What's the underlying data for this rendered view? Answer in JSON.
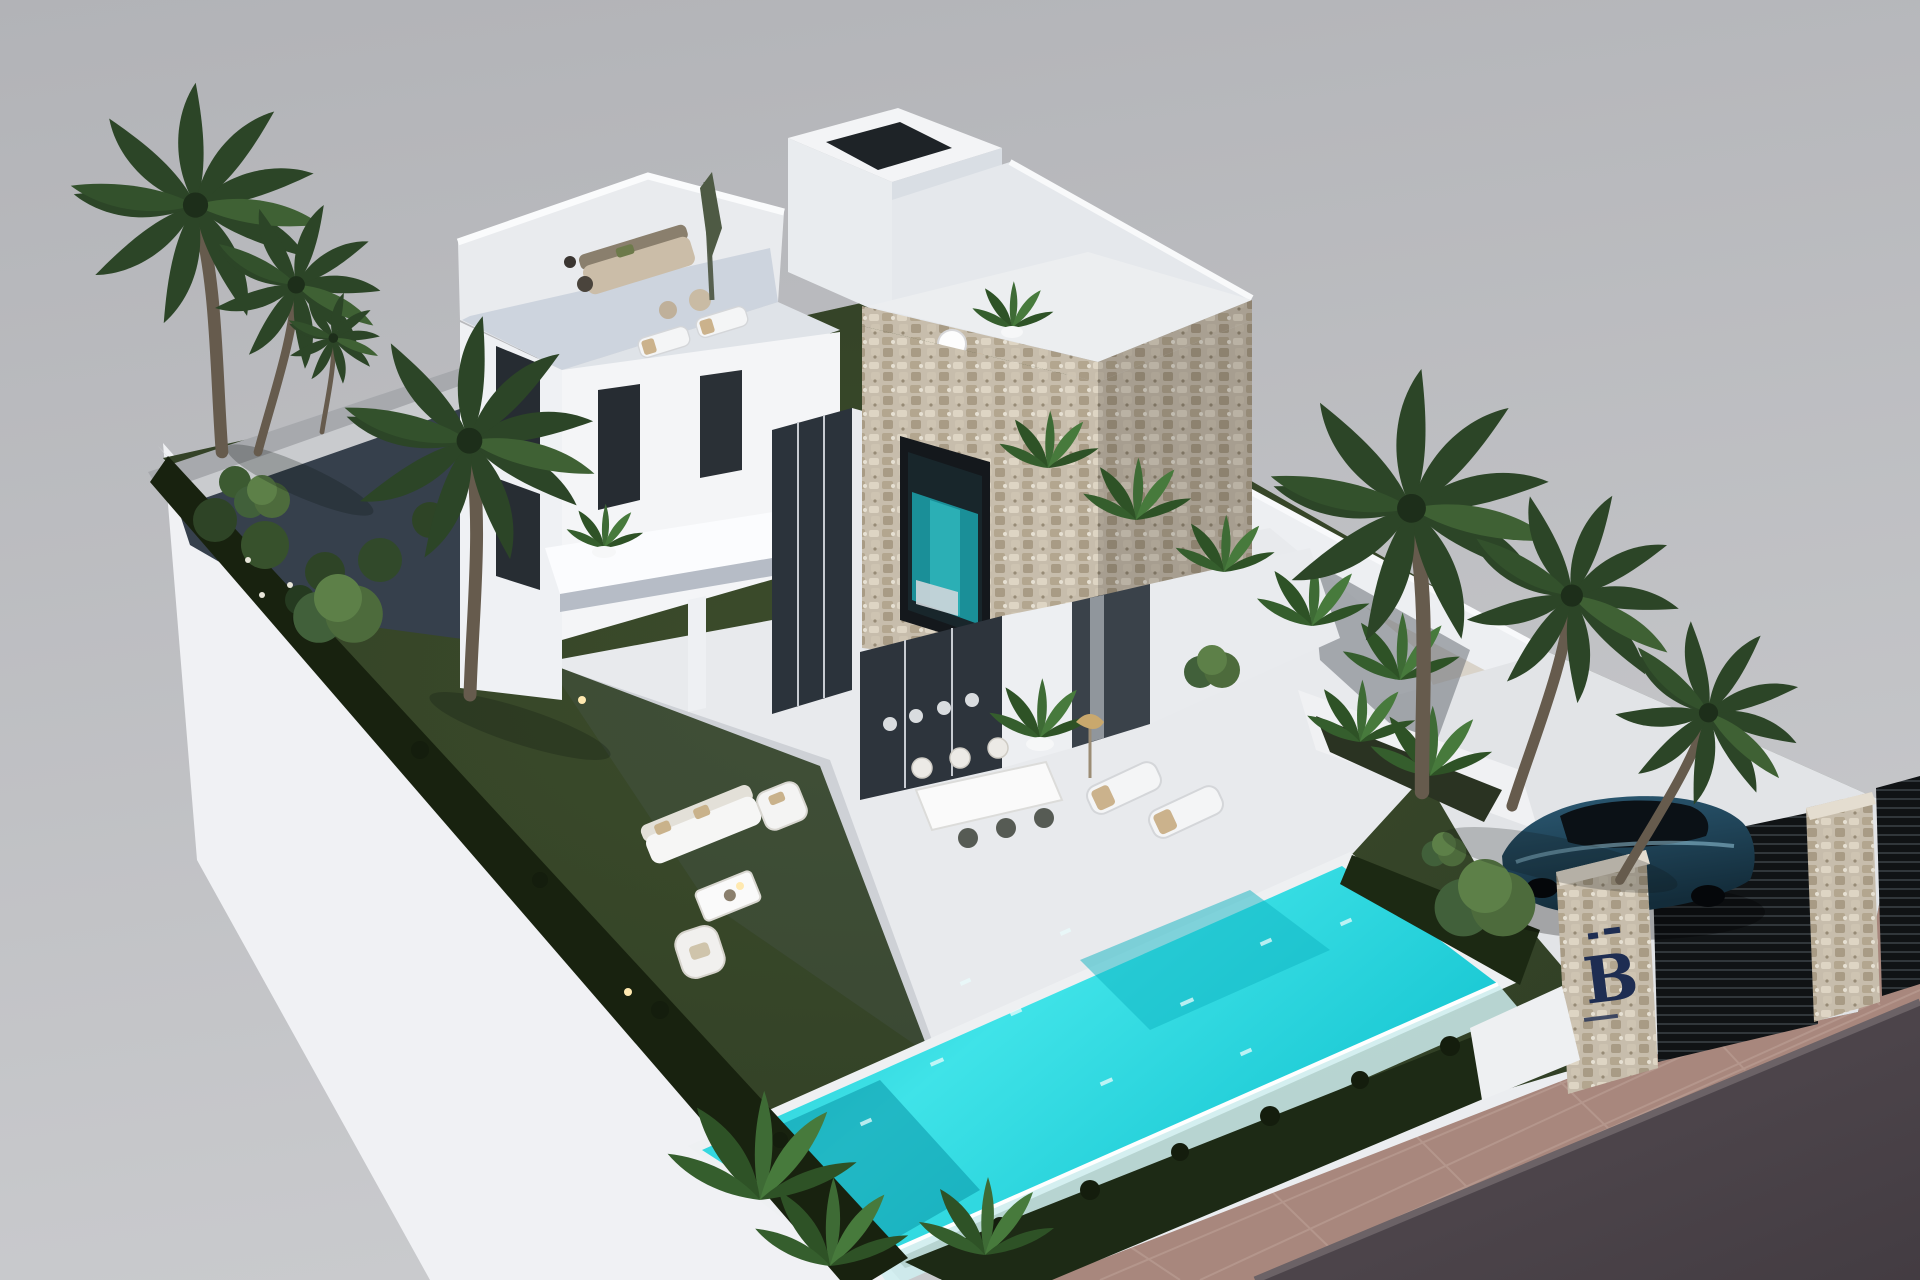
{
  "image": {
    "type": "3d-architectural-render",
    "view": "aerial-isometric",
    "subject": "Modern two-storey white villa on a walled plot with landscaped garden, turquoise pool, palm trees, gated driveway with parked car"
  },
  "gate": {
    "logo_letter": "B",
    "logo_color": "#1e2d52",
    "pillar_material": "stone"
  },
  "palette": {
    "background_gray": "#b7b8bc",
    "white_wall": "#f2f3f6",
    "wall_shadow": "#dfe3e8",
    "grass": "#2f3d25",
    "hedge": "#18220f",
    "pool_water_bright": "#3fe3e8",
    "pool_water_deep": "#0aa6b8",
    "stone_cladding": "#c7bdac",
    "glass_dark": "#2b333b",
    "interior_teal": "#1a8f98",
    "road_asphalt": "#4b434a",
    "sidewalk_pavers": "#a8877d",
    "car_body_blue": "#2c5a74",
    "palm_green": "#33512c",
    "uplight_warm": "#ffe2a8"
  },
  "features": {
    "palm_trees": 8,
    "roof_terraces": 2,
    "roof_plunge_pool": 1,
    "garden_sun_loungers": 2,
    "roof_sun_loungers": 2,
    "outdoor_dining_seats": 6,
    "swimming_pool": "raised infinity pool with glass edge",
    "car": "dark blue coupe parked behind slatted gate",
    "street": "asphalt road with brown paved sidewalk"
  }
}
